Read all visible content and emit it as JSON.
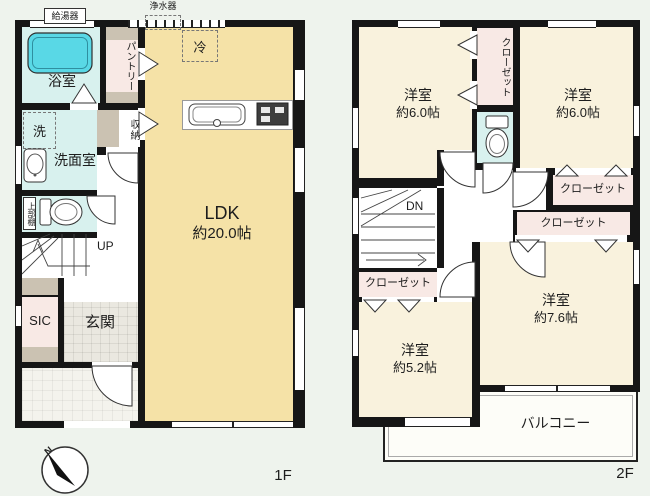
{
  "colors": {
    "wall": "#161616",
    "ldk_fill": "#f5e2a7",
    "bedroom_fill": "#f9f2dd",
    "wet_fill": "#d8f1ee",
    "closet_fill": "#f8e9e5",
    "accent_gray": "#cbc2b2",
    "bathtub": "#59d8e6",
    "background": "#eef3ed"
  },
  "floor1": {
    "floor_label": "1F",
    "water_heater": "給湯器",
    "water_purifier": "浄水器",
    "bath": "浴室",
    "pantry": "パントリー",
    "fridge": "冷",
    "washer": "洗",
    "washroom": "洗面室",
    "storage": "収納",
    "upper_shelf": "上部棚",
    "stairs_up": "UP",
    "ldk_name": "LDK",
    "ldk_size": "約20.0帖",
    "sic": "SIC",
    "entrance": "玄関"
  },
  "floor2": {
    "floor_label": "2F",
    "bedroom": "洋室",
    "size_nw": "約6.0帖",
    "size_ne": "約6.0帖",
    "size_se": "約7.6帖",
    "size_sw": "約5.2帖",
    "closet": "クローゼット",
    "balcony": "バルコニー",
    "stairs_down": "DN"
  },
  "compass": {
    "north": "N"
  }
}
